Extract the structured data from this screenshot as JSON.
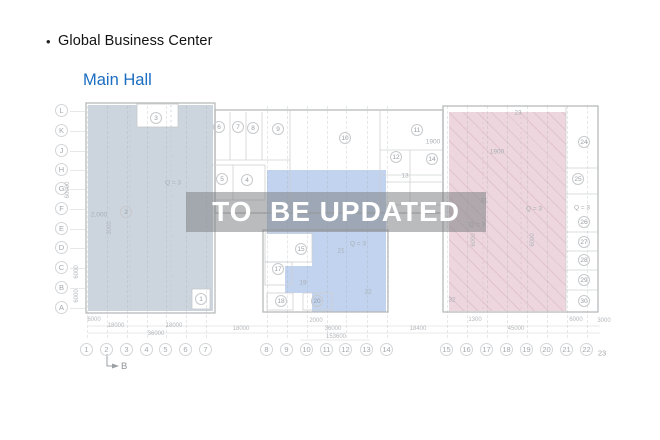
{
  "header": {
    "bullet": "•",
    "title": "Global Business Center",
    "subtitle": "Main Hall",
    "subtitle_color": "#1a6dc0"
  },
  "watermark": {
    "text": "TO  BE UPDATED"
  },
  "plan": {
    "colors": {
      "region_left": "#ccd4de",
      "region_middle": "#c1d3ee",
      "region_right": "#edd6dd"
    },
    "row_axes": [
      {
        "label": "L",
        "y": 111
      },
      {
        "label": "K",
        "y": 131
      },
      {
        "label": "J",
        "y": 151
      },
      {
        "label": "H",
        "y": 170
      },
      {
        "label": "G",
        "y": 189
      },
      {
        "label": "F",
        "y": 209
      },
      {
        "label": "E",
        "y": 229
      },
      {
        "label": "D",
        "y": 248
      },
      {
        "label": "C",
        "y": 268
      },
      {
        "label": "B",
        "y": 288
      },
      {
        "label": "A",
        "y": 308
      }
    ],
    "col_axes": [
      {
        "label": "1",
        "x": 87
      },
      {
        "label": "2",
        "x": 107
      },
      {
        "label": "3",
        "x": 127
      },
      {
        "label": "4",
        "x": 147
      },
      {
        "label": "5",
        "x": 166
      },
      {
        "label": "6",
        "x": 186
      },
      {
        "label": "7",
        "x": 206
      },
      {
        "label": "8",
        "x": 267
      },
      {
        "label": "9",
        "x": 287
      },
      {
        "label": "10",
        "x": 307
      },
      {
        "label": "11",
        "x": 327
      },
      {
        "label": "12",
        "x": 346
      },
      {
        "label": "13",
        "x": 367
      },
      {
        "label": "14",
        "x": 387
      },
      {
        "label": "15",
        "x": 447
      },
      {
        "label": "16",
        "x": 467
      },
      {
        "label": "17",
        "x": 487
      },
      {
        "label": "18",
        "x": 507
      },
      {
        "label": "19",
        "x": 527
      },
      {
        "label": "20",
        "x": 547
      },
      {
        "label": "21",
        "x": 567
      },
      {
        "label": "22",
        "x": 587
      }
    ],
    "col_axis_end": {
      "label": "23",
      "x": 602,
      "y": 353
    },
    "rooms": [
      {
        "n": "1",
        "x": 201,
        "y": 299
      },
      {
        "n": "2",
        "x": 126,
        "y": 212
      },
      {
        "n": "3",
        "x": 156,
        "y": 118
      },
      {
        "n": "4",
        "x": 247,
        "y": 180
      },
      {
        "n": "5",
        "x": 222,
        "y": 179
      },
      {
        "n": "6",
        "x": 219,
        "y": 127
      },
      {
        "n": "7",
        "x": 238,
        "y": 127
      },
      {
        "n": "8",
        "x": 253,
        "y": 128
      },
      {
        "n": "9",
        "x": 278,
        "y": 129
      },
      {
        "n": "10",
        "x": 345,
        "y": 138
      },
      {
        "n": "11",
        "x": 417,
        "y": 130
      },
      {
        "n": "12",
        "x": 396,
        "y": 157
      },
      {
        "n": "14",
        "x": 432,
        "y": 159
      },
      {
        "n": "15",
        "x": 301,
        "y": 249
      },
      {
        "n": "17",
        "x": 278,
        "y": 269
      },
      {
        "n": "18",
        "x": 281,
        "y": 301
      },
      {
        "n": "20",
        "x": 317,
        "y": 301
      },
      {
        "n": "24",
        "x": 584,
        "y": 142
      },
      {
        "n": "25",
        "x": 578,
        "y": 179
      },
      {
        "n": "26",
        "x": 584,
        "y": 222
      },
      {
        "n": "27",
        "x": 584,
        "y": 242
      },
      {
        "n": "28",
        "x": 584,
        "y": 260
      },
      {
        "n": "29",
        "x": 584,
        "y": 280
      },
      {
        "n": "30",
        "x": 584,
        "y": 301
      }
    ],
    "annotations": [
      {
        "t": "2,000",
        "x": 99,
        "y": 215
      },
      {
        "t": "Q = 3",
        "x": 173,
        "y": 183
      },
      {
        "t": "Q = 3",
        "x": 358,
        "y": 244
      },
      {
        "t": "Q = 3",
        "x": 477,
        "y": 225
      },
      {
        "t": "Q = 3",
        "x": 534,
        "y": 209
      },
      {
        "t": "Q = 3",
        "x": 582,
        "y": 208
      },
      {
        "t": "13",
        "x": 405,
        "y": 176
      },
      {
        "t": "19",
        "x": 303,
        "y": 283
      },
      {
        "t": "21",
        "x": 341,
        "y": 251
      },
      {
        "t": "22",
        "x": 368,
        "y": 292
      },
      {
        "t": "23",
        "x": 518,
        "y": 113
      },
      {
        "t": "31",
        "x": 484,
        "y": 201
      },
      {
        "t": "32",
        "x": 452,
        "y": 300
      },
      {
        "t": "1900",
        "x": 433,
        "y": 142
      },
      {
        "t": "1900",
        "x": 497,
        "y": 152
      }
    ],
    "dimensions": [
      {
        "t": "6000",
        "x": 94,
        "y": 320
      },
      {
        "t": "18000",
        "x": 116,
        "y": 326
      },
      {
        "t": "18000",
        "x": 174,
        "y": 326
      },
      {
        "t": "36000",
        "x": 156,
        "y": 334
      },
      {
        "t": "18000",
        "x": 241,
        "y": 329
      },
      {
        "t": "2000",
        "x": 316,
        "y": 321
      },
      {
        "t": "36000",
        "x": 333,
        "y": 329
      },
      {
        "t": "153600",
        "x": 336,
        "y": 337
      },
      {
        "t": "18400",
        "x": 418,
        "y": 329
      },
      {
        "t": "1300",
        "x": 475,
        "y": 320
      },
      {
        "t": "45000",
        "x": 516,
        "y": 329
      },
      {
        "t": "6000",
        "x": 576,
        "y": 320
      },
      {
        "t": "3000",
        "x": 604,
        "y": 321
      }
    ],
    "dimensions_rotated": [
      {
        "t": "60000",
        "x": 68,
        "y": 190
      },
      {
        "t": "6000",
        "x": 77,
        "y": 272
      },
      {
        "t": "6000",
        "x": 77,
        "y": 296
      },
      {
        "t": "3000",
        "x": 110,
        "y": 228
      },
      {
        "t": "6000",
        "x": 474,
        "y": 240
      },
      {
        "t": "6000",
        "x": 533,
        "y": 240
      }
    ],
    "section_marker": {
      "label": "B"
    }
  }
}
